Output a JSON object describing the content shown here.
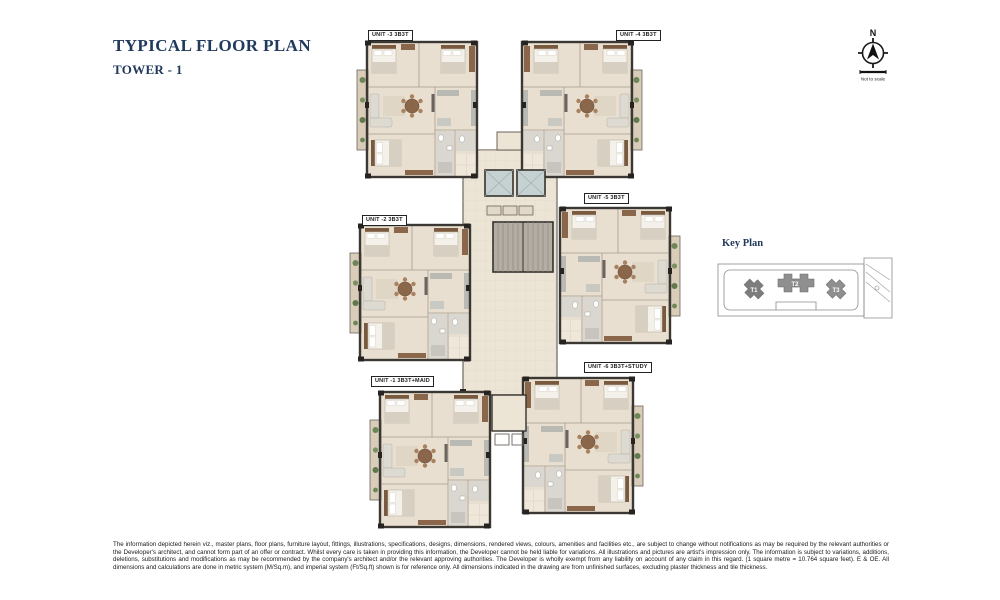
{
  "header": {
    "title": "TYPICAL FLOOR PLAN",
    "subtitle": "TOWER - 1"
  },
  "compass": {
    "letter": "N",
    "note": "Not to scale"
  },
  "floor_plan": {
    "units": [
      {
        "id": "unit-3",
        "label": "UNIT -3 3B3T"
      },
      {
        "id": "unit-4",
        "label": "UNIT -4 3B3T"
      },
      {
        "id": "unit-5",
        "label": "UNIT -5 3B3T"
      },
      {
        "id": "unit-2",
        "label": "UNIT -2 3B3T"
      },
      {
        "id": "unit-1",
        "label": "UNIT -1 3B3T+MAID"
      },
      {
        "id": "unit-6",
        "label": "UNIT -6 3B3T+STUDY"
      }
    ]
  },
  "key_plan": {
    "title": "Key Plan",
    "towers": [
      {
        "label": "T1",
        "highlighted": true
      },
      {
        "label": "T2",
        "highlighted": false
      },
      {
        "label": "T3",
        "highlighted": false
      }
    ]
  },
  "disclaimer": "The information depicted herein viz., master plans, floor plans, furniture layout, fittings, illustrations, specifications, designs, dimensions, rendered views, colours, amenities and facilities etc., are subject to change without notifications as may be required by the relevant authorities or the Developer's architect, and cannot form part of an offer or contract. Whilst every care is taken in providing this information, the Developer cannot be held liable for variations. All illustrations and pictures are artist's impression only. The information is subject to variations, additions, deletions, substitutions and modifications as may be recommended by the company's architect and/or the relevant approving authorities. The Developer is wholly exempt from any liability on account of any claim in this regard. (1 square metre = 10.764 square feet). E & OE. All dimensions and calculations are done in metric system (M/Sq.m), and imperial system (Ft/Sq.ft) shown is for reference only. All dimensions indicated in the drawing are from unfinished surfaces, excluding plaster thickness and tile thickness.",
  "colors": {
    "accent_navy": "#21395c",
    "wall": "#3b3733",
    "floor": "#e9dfd0",
    "corridor": "#ece4d5",
    "wood": "#8a664a",
    "balcony": "#d9cdb9",
    "plant_green": "#6d8657",
    "lift": "#c6d1d2",
    "stair": "#b3ada3",
    "keyplan_gray": "#8f8f8f"
  }
}
